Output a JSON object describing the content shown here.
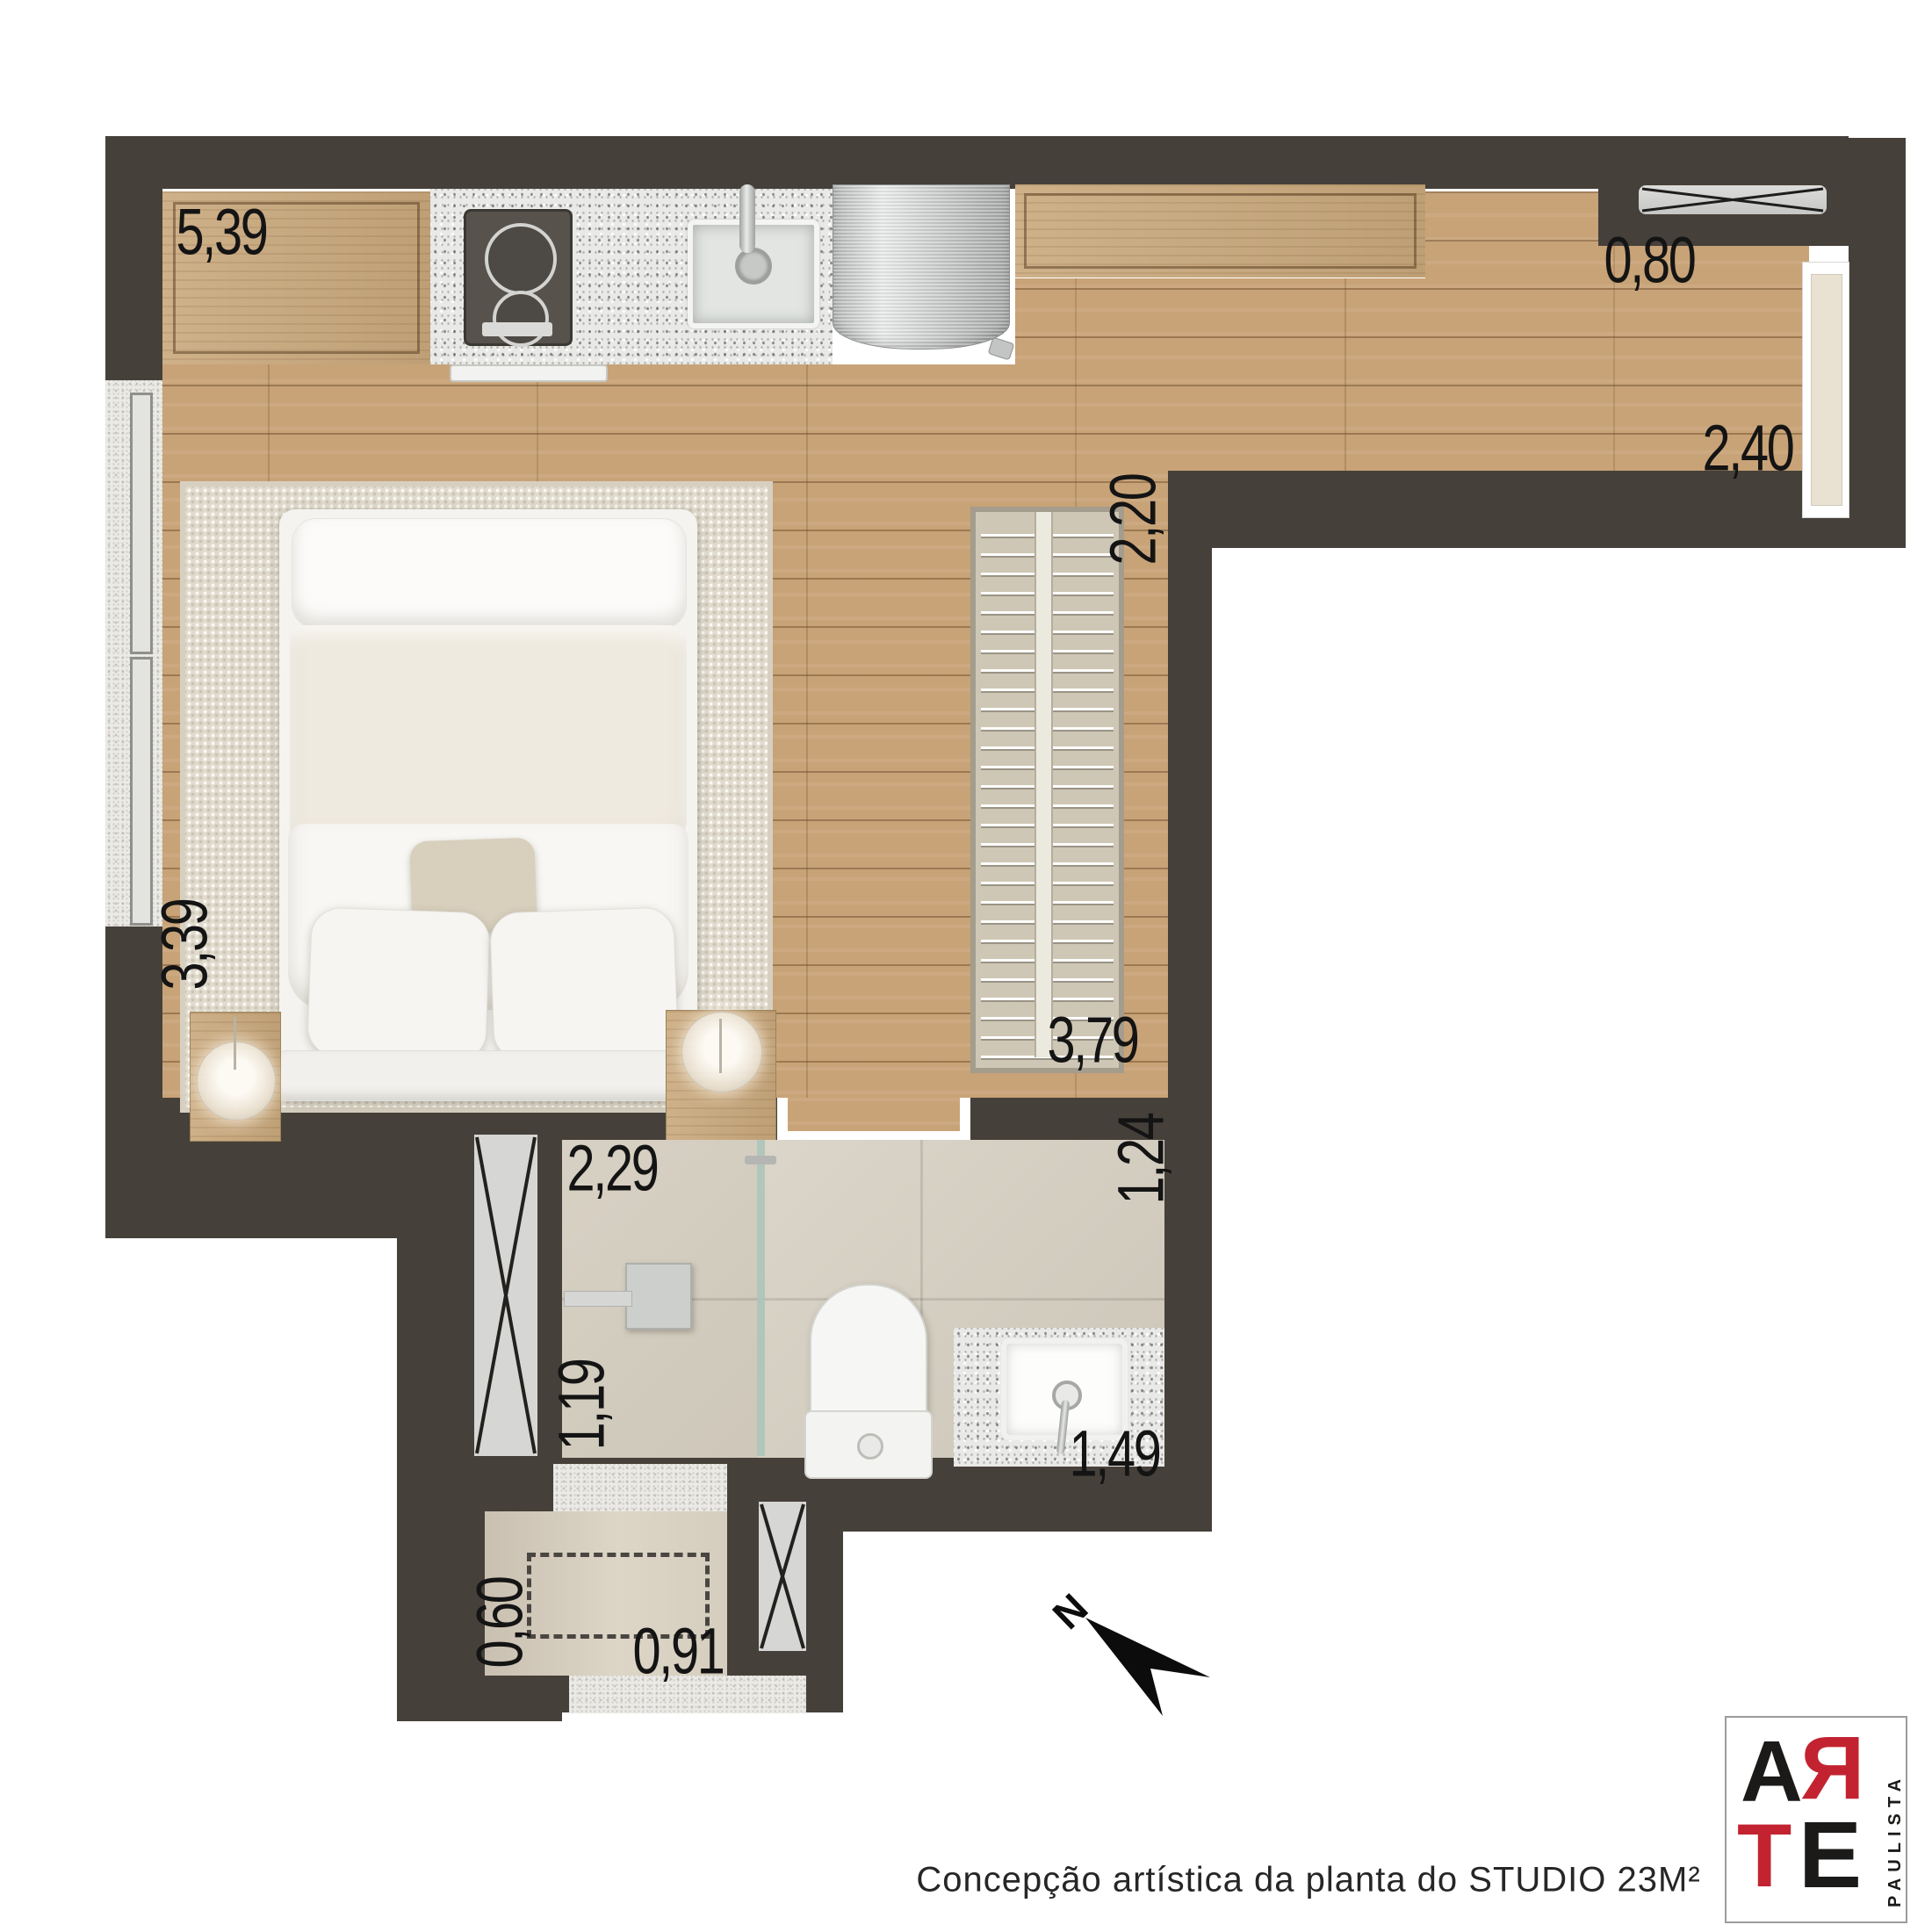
{
  "caption": "Concepção artística da planta do STUDIO 23M²",
  "compass": {
    "label": "N"
  },
  "logo": {
    "letter_a": "A",
    "letter_r": "Я",
    "letter_t": "T",
    "letter_e": "E",
    "side_text": "PAULISTA",
    "red": "#c32330",
    "black": "#1b1a18"
  },
  "dimensions": {
    "kitchen_run": "5,39",
    "entry_recess": "0,80",
    "entry_hall_width": "2,40",
    "closet_length": "2,20",
    "bedroom_side": "3,39",
    "closet_run": "3,79",
    "bathroom_width": "2,29",
    "bathroom_depth": "1,24",
    "shower_depth": "1,19",
    "vanity_run": "1,49",
    "laundry_depth": "0,60",
    "laundry_width": "0,91"
  },
  "materials": {
    "wall_color": "#46403a",
    "wood_floor": "#c8a377",
    "granite": "#e9e9e7",
    "bath_tile": "#d9d2c4",
    "rug": "#e1dbce",
    "glass": "#adc4b9"
  }
}
